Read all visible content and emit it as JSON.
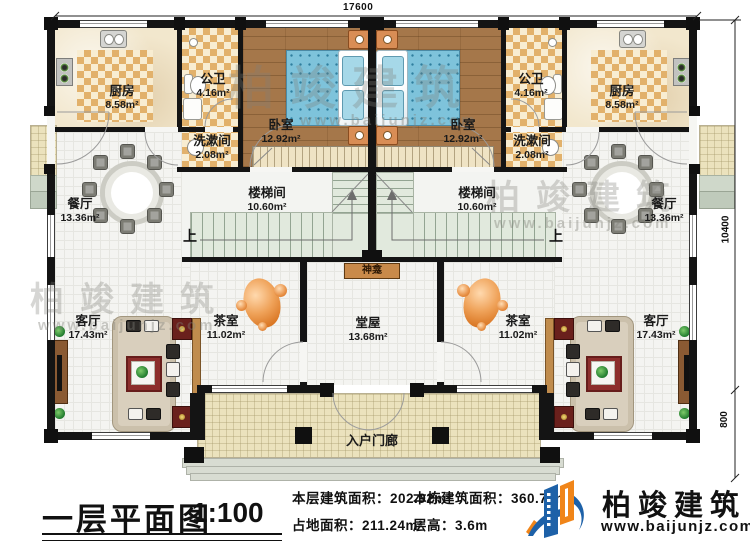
{
  "dimensions": {
    "top": "17600",
    "right_main": "10400",
    "right_porch": "800"
  },
  "rooms": {
    "kitchen": {
      "name": "厨房",
      "area": "8.58m²"
    },
    "public_bath": {
      "name": "公卫",
      "area": "4.16m²"
    },
    "washroom": {
      "name": "洗漱间",
      "area": "2.08m²"
    },
    "bedroom": {
      "name": "卧室",
      "area": "12.92m²"
    },
    "dining": {
      "name": "餐厅",
      "area": "13.36m²"
    },
    "stairwell": {
      "name": "楼梯间",
      "area": "10.60m²"
    },
    "living": {
      "name": "客厅",
      "area": "17.43m²"
    },
    "tea": {
      "name": "茶室",
      "area": "11.02m²"
    },
    "hall": {
      "name": "堂屋",
      "area": "13.68m²"
    },
    "shrine": {
      "name": "神龛"
    },
    "entry_porch": {
      "name": "入户门廊"
    }
  },
  "stairs": {
    "up": "上"
  },
  "title_block": {
    "title": "一层平面图",
    "scale": "1:100",
    "stats": [
      {
        "label": "本层建筑面积：",
        "value": "202.92m²"
      },
      {
        "label": "占地面积：",
        "value": "211.24m²"
      },
      {
        "label": "本栋建筑面积：",
        "value": "360.72m²"
      },
      {
        "label": "层高：",
        "value": "3.6m"
      }
    ]
  },
  "brand": {
    "name": "柏竣建筑",
    "url": "www.baijunjz.com"
  },
  "watermark": {
    "name": "柏竣建筑",
    "url": "www.baijunjz.com"
  },
  "colors": {
    "brand_blue": "#1d61a8",
    "brand_orange": "#f08519",
    "wall": "#141414"
  }
}
